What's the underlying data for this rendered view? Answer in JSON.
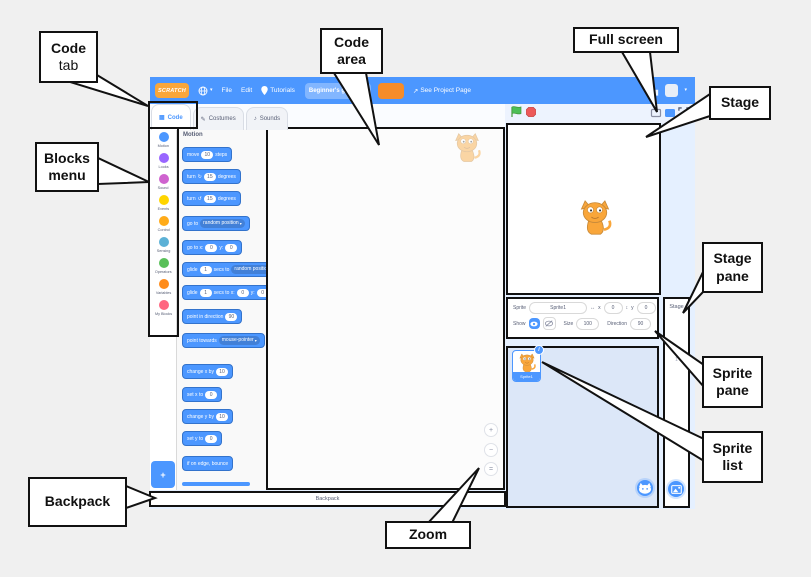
{
  "callouts": {
    "code_tab": {
      "line1": "Code",
      "line2": "tab"
    },
    "blocks_menu": {
      "line1": "Blocks",
      "line2": "menu"
    },
    "code_area": {
      "line1": "Code",
      "line2": "area"
    },
    "full_screen": {
      "line1": "Full screen"
    },
    "stage": {
      "line1": "Stage"
    },
    "stage_pane": {
      "line1": "Stage",
      "line2": "pane"
    },
    "sprite_pane": {
      "line1": "Sprite",
      "line2": "pane"
    },
    "sprite_list": {
      "line1": "Sprite",
      "line2": "list"
    },
    "backpack": {
      "line1": "Backpack"
    },
    "zoom": {
      "line1": "Zoom"
    }
  },
  "menubar": {
    "logo": "SCRATCH",
    "menus": [
      "File",
      "Edit"
    ],
    "tutorials": "Tutorials",
    "project_name": "Beginner's guide",
    "see_project_page": "See Project Page"
  },
  "tabs": [
    {
      "label": "Code",
      "icon_name": "code-blocks-icon",
      "icon": "▦",
      "active": true
    },
    {
      "label": "Costumes",
      "icon_name": "brush-icon",
      "icon": "✎",
      "active": false
    },
    {
      "label": "Sounds",
      "icon_name": "speaker-icon",
      "icon": "♪",
      "active": false
    }
  ],
  "categories": [
    {
      "label": "Motion",
      "color": "#4c97ff"
    },
    {
      "label": "Looks",
      "color": "#9966ff"
    },
    {
      "label": "Sound",
      "color": "#cf63cf"
    },
    {
      "label": "Events",
      "color": "#ffd500"
    },
    {
      "label": "Control",
      "color": "#ffab19"
    },
    {
      "label": "Sensing",
      "color": "#5cb1d6"
    },
    {
      "label": "Operators",
      "color": "#59c059"
    },
    {
      "label": "Variables",
      "color": "#ff8c1a"
    },
    {
      "label": "My Blocks",
      "color": "#ff6680"
    }
  ],
  "palette": {
    "header": "Motion",
    "blocks": [
      {
        "tokens": [
          {
            "t": "move"
          },
          {
            "i": "10"
          },
          {
            "t": "steps"
          }
        ]
      },
      {
        "tokens": [
          {
            "t": "turn"
          },
          {
            "g": "↻"
          },
          {
            "i": "15"
          },
          {
            "t": "degrees"
          }
        ]
      },
      {
        "tokens": [
          {
            "t": "turn"
          },
          {
            "g": "↺"
          },
          {
            "i": "15"
          },
          {
            "t": "degrees"
          }
        ]
      },
      {
        "tokens": [
          {
            "t": "go to"
          },
          {
            "d": "random position"
          }
        ]
      },
      {
        "tokens": [
          {
            "t": "go to x:"
          },
          {
            "i": "0"
          },
          {
            "t": "y:"
          },
          {
            "i": "0"
          }
        ]
      },
      {
        "tokens": [
          {
            "t": "glide"
          },
          {
            "i": "1"
          },
          {
            "t": "secs to"
          },
          {
            "d": "random position"
          }
        ]
      },
      {
        "tokens": [
          {
            "t": "glide"
          },
          {
            "i": "1"
          },
          {
            "t": "secs to x:"
          },
          {
            "i": "0"
          },
          {
            "t": "y:"
          },
          {
            "i": "0"
          }
        ]
      },
      {
        "tokens": [
          {
            "t": "point in direction"
          },
          {
            "i": "90"
          }
        ]
      },
      {
        "tokens": [
          {
            "t": "point towards"
          },
          {
            "d": "mouse-pointer"
          }
        ]
      },
      {
        "tokens": [
          {
            "t": "change x by"
          },
          {
            "i": "10"
          }
        ]
      },
      {
        "tokens": [
          {
            "t": "set x to"
          },
          {
            "i": "0"
          }
        ]
      },
      {
        "tokens": [
          {
            "t": "change y by"
          },
          {
            "i": "10"
          }
        ]
      },
      {
        "tokens": [
          {
            "t": "set y to"
          },
          {
            "i": "0"
          }
        ]
      },
      {
        "tokens": [
          {
            "t": "if on edge, bounce"
          }
        ]
      }
    ]
  },
  "backpack": {
    "label": "Backpack"
  },
  "sprite_pane": {
    "sprite_label": "Sprite",
    "sprite_name": "Sprite1",
    "x_label": "x",
    "x_value": "0",
    "y_label": "y",
    "y_value": "0",
    "show_label": "Show",
    "size_label": "Size",
    "size_value": "100",
    "direction_label": "Direction",
    "direction_value": "90"
  },
  "sprite_list": {
    "sprites": [
      {
        "name": "Sprite1",
        "selected": true
      }
    ]
  },
  "stage_pane": {
    "title": "Stage",
    "backdrops_count": "1"
  },
  "colors": {
    "menubar_blue": "#4c97ff",
    "logo_orange": "#f9a63a",
    "share_orange": "#f68c29",
    "green_flag": "#4cbf56",
    "stop_red": "#ec5959",
    "annotation_black": "#111111"
  },
  "icons": {
    "caret_down": "▾",
    "external_link": "↗",
    "x_arrows": "↔",
    "y_arrows": "↕",
    "zoom_in": "+",
    "zoom_out": "−",
    "zoom_reset": "=",
    "info_badge": "i",
    "add_extension": "+"
  }
}
